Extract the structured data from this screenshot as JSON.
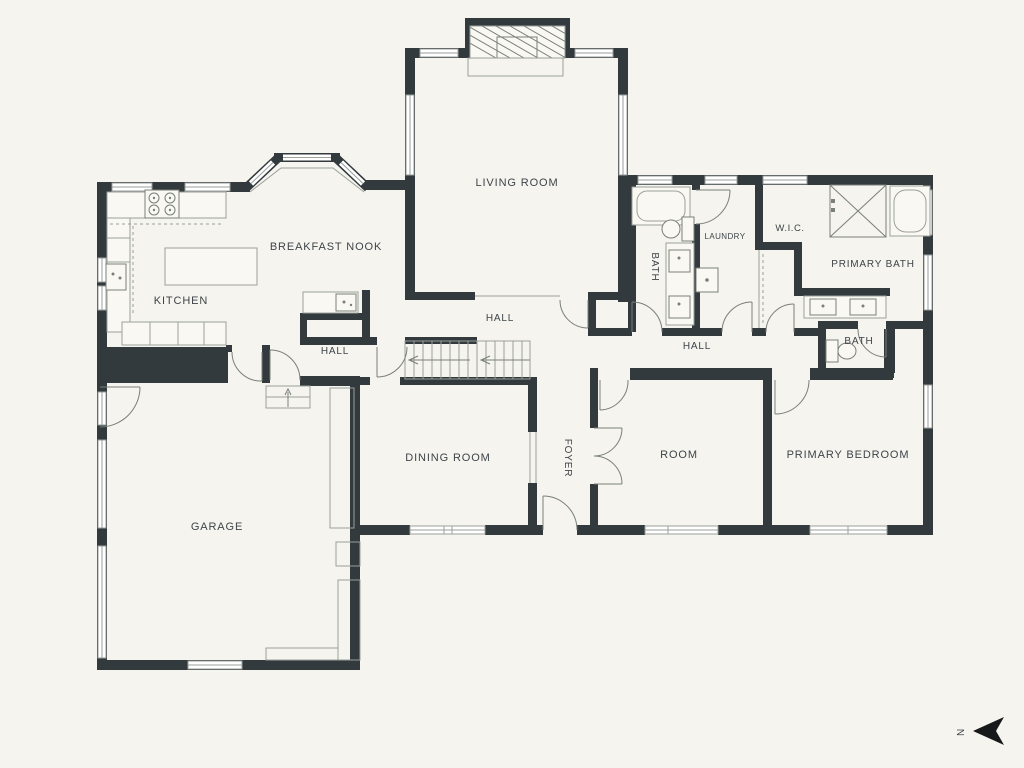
{
  "colors": {
    "background": "#f5f4ee",
    "wall": "#333a3e",
    "line": "#9a9f9b",
    "line_dark": "#7a7f7b",
    "text": "#3e4449",
    "window_fill": "#ffffff",
    "fixture_fill": "#f9f8f2",
    "arrow": "#16181a"
  },
  "compass": {
    "label": "N"
  },
  "rooms": [
    {
      "id": "living-room",
      "label": "LIVING ROOM"
    },
    {
      "id": "breakfast-nook",
      "label": "BREAKFAST NOOK"
    },
    {
      "id": "kitchen",
      "label": "KITCHEN"
    },
    {
      "id": "hall-center",
      "label": "HALL"
    },
    {
      "id": "hall-kitchen",
      "label": "HALL"
    },
    {
      "id": "hall-bedrooms",
      "label": "HALL"
    },
    {
      "id": "bath-hall",
      "label": "BATH"
    },
    {
      "id": "laundry",
      "label": "LAUNDRY"
    },
    {
      "id": "wic",
      "label": "W.I.C."
    },
    {
      "id": "primary-bath",
      "label": "PRIMARY BATH"
    },
    {
      "id": "bath-primary",
      "label": "BATH"
    },
    {
      "id": "garage",
      "label": "GARAGE"
    },
    {
      "id": "dining-room",
      "label": "DINING ROOM"
    },
    {
      "id": "foyer",
      "label": "FOYER"
    },
    {
      "id": "room",
      "label": "ROOM"
    },
    {
      "id": "primary-bedroom",
      "label": "PRIMARY BEDROOM"
    }
  ]
}
